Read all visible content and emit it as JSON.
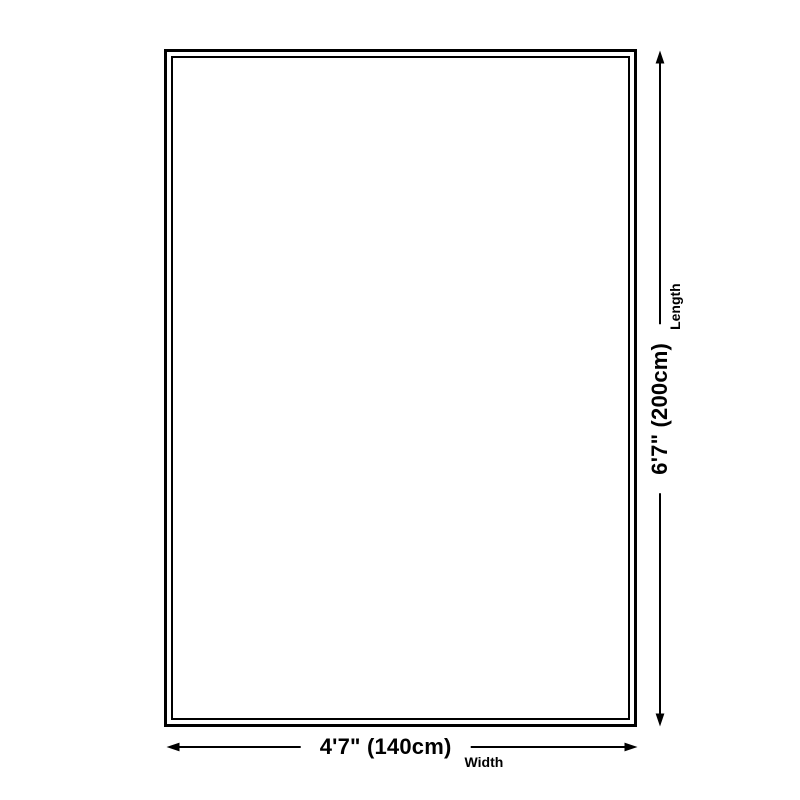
{
  "canvas": {
    "background": "#ffffff",
    "ink": "#000000"
  },
  "diagram": {
    "kind": "product-size-diagram",
    "outline": "rectangle-double-border",
    "width_dimension": {
      "value": "4'7\" (140cm)",
      "label": "Width"
    },
    "length_dimension": {
      "value": "6'7\" (200cm)",
      "label": "Length"
    }
  }
}
